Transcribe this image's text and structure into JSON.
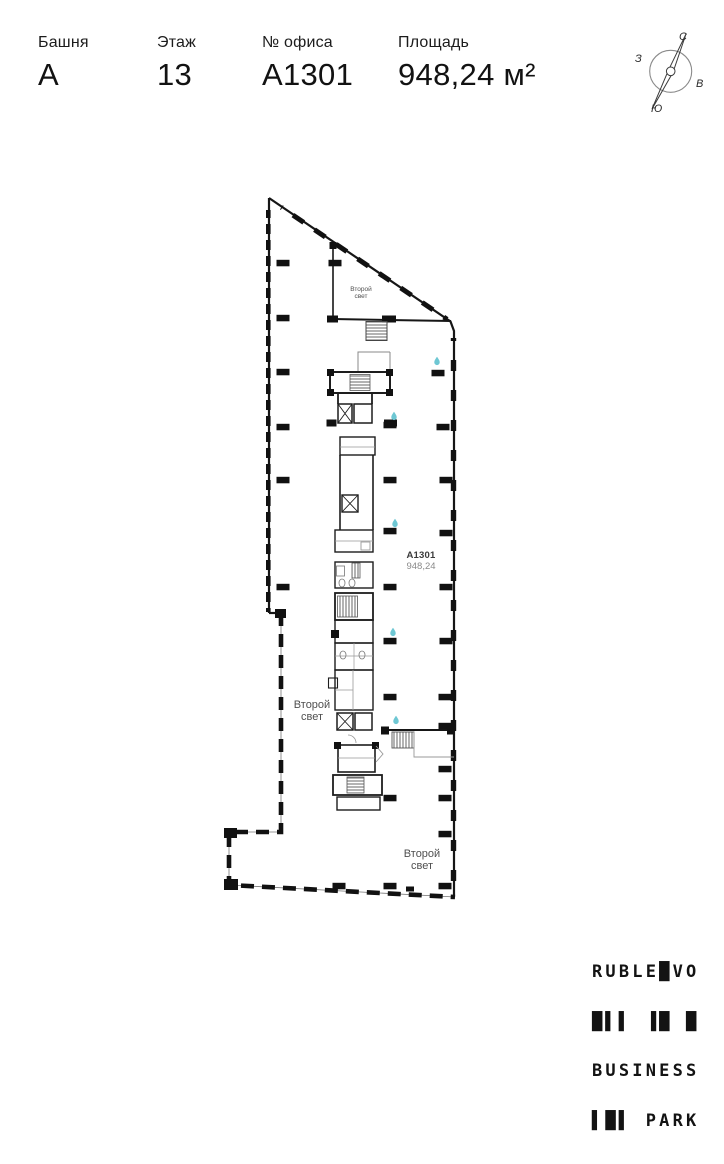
{
  "header": {
    "fields": [
      {
        "label": "Башня",
        "value": "А"
      },
      {
        "label": "Этаж",
        "value": "13"
      },
      {
        "label": "№ офиса",
        "value": "А1301"
      },
      {
        "label": "Площадь",
        "value": "948,24 м²"
      }
    ]
  },
  "compass": {
    "north": "С",
    "south": "Ю",
    "west": "З",
    "east": "В"
  },
  "plan": {
    "unit_code": "А1301",
    "unit_area": "948,24",
    "void_top": {
      "line1": "Второй",
      "line2": "свет"
    },
    "void_left": {
      "line1": "Второй",
      "line2": "свет"
    },
    "void_bottom": {
      "line1": "Второй",
      "line2": "свет"
    }
  },
  "logo": {
    "row1": "RUBLE█VO",
    "row2": "█▌▌ ▐█ █",
    "row3": "BUSINESS",
    "row4": "▌█▌ PARK"
  },
  "theme": {
    "accent_droplet": "#6ec7d3",
    "ink": "#161616",
    "line_gray": "#8d8d8d"
  }
}
